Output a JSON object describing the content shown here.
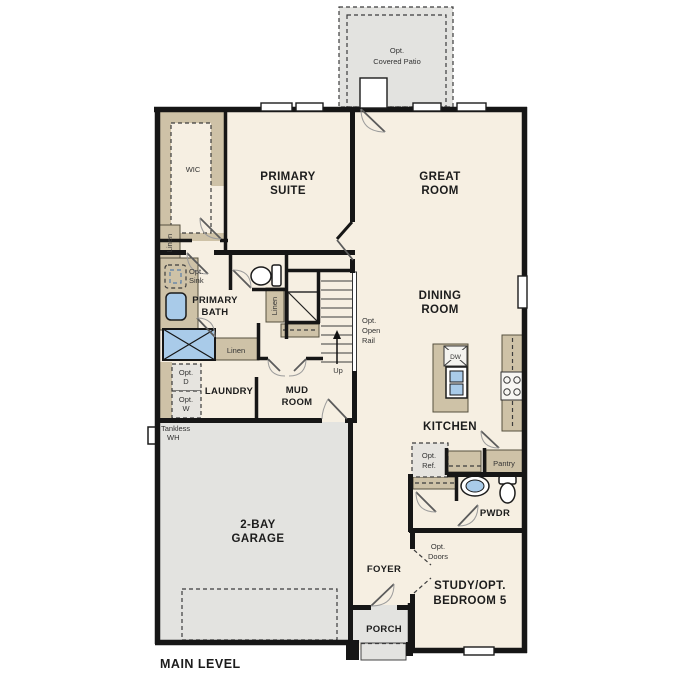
{
  "plan_title": "MAIN LEVEL",
  "colors": {
    "wall": "#161616",
    "floor": "#f6efe2",
    "concrete": "#e3e3e0",
    "cabinet": "#cec2a7",
    "fixture": "#a9cbe9",
    "background": "#ffffff",
    "label": "#1c1c1c",
    "annotation": "#333333"
  },
  "rooms": {
    "covered_patio": {
      "lines": [
        "Opt.",
        "Covered Patio"
      ]
    },
    "wic": {
      "lines": [
        "WIC"
      ]
    },
    "primary_suite": {
      "lines": [
        "PRIMARY",
        "SUITE"
      ]
    },
    "great_room": {
      "lines": [
        "GREAT",
        "ROOM"
      ]
    },
    "dining_room": {
      "lines": [
        "DINING",
        "ROOM"
      ]
    },
    "primary_bath": {
      "lines": [
        "PRIMARY",
        "BATH"
      ]
    },
    "laundry": {
      "lines": [
        "LAUNDRY"
      ]
    },
    "mud_room": {
      "lines": [
        "MUD",
        "ROOM"
      ]
    },
    "kitchen": {
      "lines": [
        "KITCHEN"
      ]
    },
    "garage": {
      "lines": [
        "2-BAY",
        "GARAGE"
      ]
    },
    "foyer": {
      "lines": [
        "FOYER"
      ]
    },
    "porch": {
      "lines": [
        "PORCH"
      ]
    },
    "pwdr": {
      "lines": [
        "PWDR"
      ]
    },
    "study": {
      "lines": [
        "STUDY/OPT.",
        "BEDROOM 5"
      ]
    }
  },
  "annotations": {
    "linen_wic": "Linen",
    "linen_stair": "Linen",
    "linen_hall": "Linen",
    "opt_sink": {
      "lines": [
        "Opt.",
        "Sink"
      ]
    },
    "opt_dryer": {
      "lines": [
        "Opt.",
        "D"
      ]
    },
    "opt_washer": {
      "lines": [
        "Opt.",
        "W"
      ]
    },
    "tankless_wh": {
      "lines": [
        "Tankless",
        "WH"
      ]
    },
    "stairs_up": "Up",
    "opt_open_rail": {
      "lines": [
        "Opt.",
        "Open",
        "Rail"
      ]
    },
    "dishwasher": "DW",
    "opt_ref": {
      "lines": [
        "Opt.",
        "Ref."
      ]
    },
    "pantry": "Pantry",
    "opt_doors": {
      "lines": [
        "Opt.",
        "Doors"
      ]
    }
  },
  "fixtures": [
    "toilet",
    "sink",
    "shower",
    "stove",
    "dishwasher",
    "kitchen-island",
    "refrigerator",
    "washer",
    "dryer",
    "water-heater",
    "stairs",
    "window",
    "door",
    "garage-door"
  ]
}
